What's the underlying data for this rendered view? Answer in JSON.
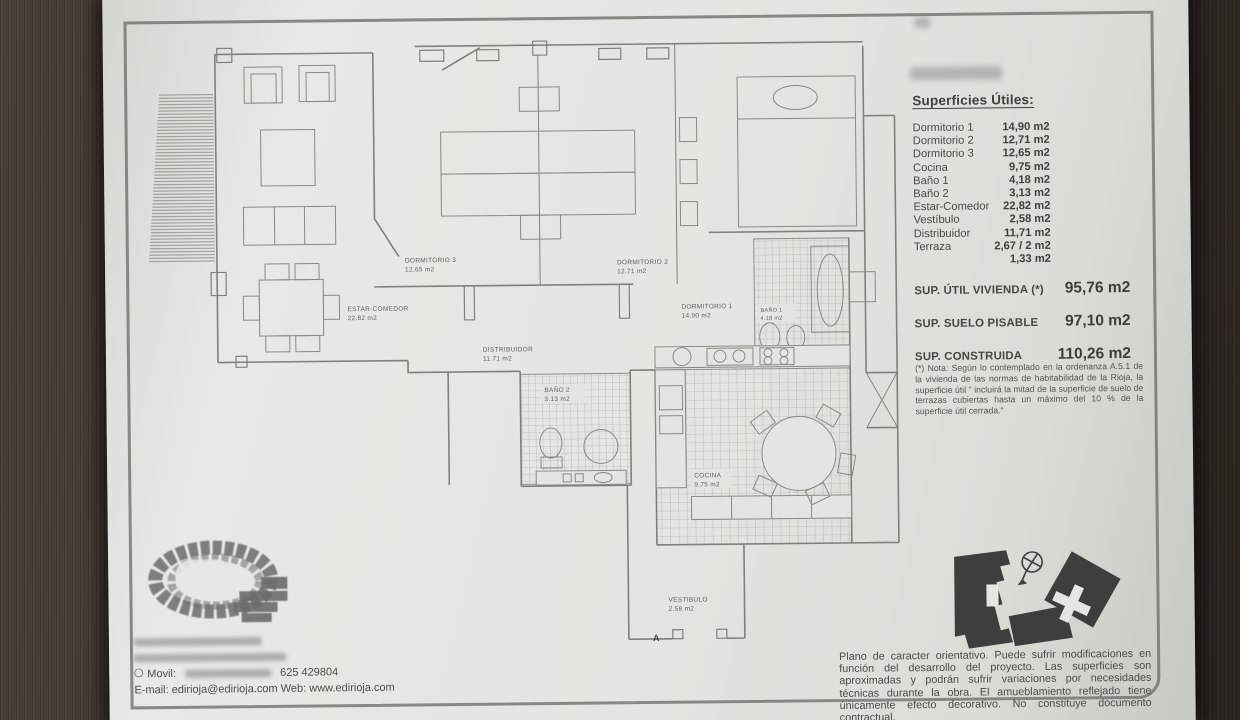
{
  "colors": {
    "paper": "#e3e5e0",
    "wood": "#3a322b",
    "ink": "#4a4c46",
    "plan_line": "#84877f",
    "silhouette": "#3c3f3b"
  },
  "surfaces": {
    "title": "Superficies Útiles:",
    "rows": [
      {
        "label": "Dormitorio 1",
        "value": "14,90 m2"
      },
      {
        "label": "Dormitorio 2",
        "value": "12,71 m2"
      },
      {
        "label": "Dormitorio 3",
        "value": "12,65 m2"
      },
      {
        "label": "Cocina",
        "value": "9,75 m2"
      },
      {
        "label": "Baño 1",
        "value": "4,18 m2"
      },
      {
        "label": "Baño 2",
        "value": "3,13 m2"
      },
      {
        "label": "Estar-Comedor",
        "value": "22,82 m2"
      },
      {
        "label": "Vestíbulo",
        "value": "2,58 m2"
      },
      {
        "label": "Distribuidor",
        "value": "11,71 m2"
      },
      {
        "label": "Terraza",
        "value": "2,67 / 2 m2"
      },
      {
        "label": "",
        "value": "1,33 m2"
      }
    ],
    "totals": [
      {
        "label": "SUP. ÚTIL VIVIENDA (*)",
        "value": "95,76 m2"
      },
      {
        "label": "SUP. SUELO PISABLE",
        "value": "97,10 m2"
      },
      {
        "label": "SUP. CONSTRUIDA",
        "value": "110,26 m2"
      }
    ],
    "note": "(*) Nota: Según lo contemplado en la ordenanza A.5.1 de la vivienda de las normas de habitabilidad de la Rioja, la superficie útil \" incluirá la mitad de la superficie de suelo de terrazas cubiertas hasta un máximo del 10 % de la superficie útil cerrada.\""
  },
  "plan": {
    "rooms": [
      {
        "name": "ESTAR-COMEDOR",
        "area": "22.82 m2"
      },
      {
        "name": "DORMITORIO 3",
        "area": "12.65 m2"
      },
      {
        "name": "DORMITORIO 2",
        "area": "12.71 m2"
      },
      {
        "name": "DORMITORIO 1",
        "area": "14.90 m2"
      },
      {
        "name": "DISTRIBUIDOR",
        "area": "11.71 m2"
      },
      {
        "name": "BAÑO 2",
        "area": "3.13 m2"
      },
      {
        "name": "BAÑO 1",
        "area": "4.18 m2"
      },
      {
        "name": "COCINA",
        "area": "9.75 m2"
      },
      {
        "name": "VESTIBULO",
        "area": "2.58 m2"
      }
    ],
    "entrance_marker": "A"
  },
  "contact": {
    "movil_label": "Movil:",
    "movil_number": "625 429804",
    "email_web": "E-mail: edirioja@edirioja.com Web: www.edirioja.com"
  },
  "disclaimer": "Plano de caracter orientativo. Puede sufrir modificaciones en función del desarrollo del proyecto. Las superficies son aproximadas y podrán sufrir variaciones por necesidades técnicas durante la obra. El amueblamiento reflejado tiene únicamente efecto decorativo. No constituye documento contractual."
}
